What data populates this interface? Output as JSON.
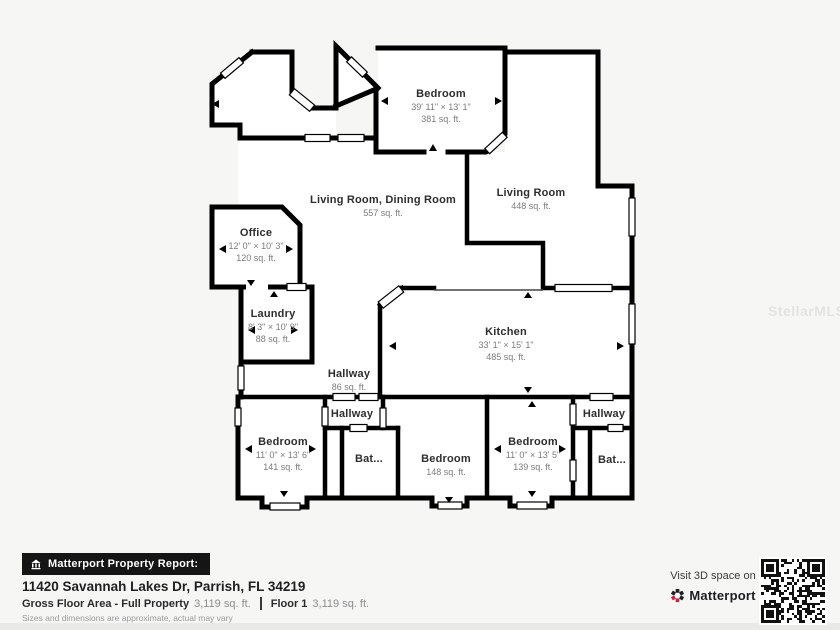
{
  "plan": {
    "rooms": [
      {
        "name": "Bedroom",
        "dims": "39' 11\" × 13' 1\"",
        "area": "381 sq. ft."
      },
      {
        "name": "Living Room, Dining Room",
        "area": "557 sq. ft."
      },
      {
        "name": "Living Room",
        "area": "448 sq. ft."
      },
      {
        "name": "Office",
        "dims": "12' 0\" × 10' 3\"",
        "area": "120 sq. ft."
      },
      {
        "name": "Laundry",
        "dims": "8' 3\" × 10' 9\"",
        "area": "88 sq. ft."
      },
      {
        "name": "Hallway",
        "area": "86 sq. ft."
      },
      {
        "name": "Kitchen",
        "dims": "33' 1\" × 15' 1\"",
        "area": "485 sq. ft."
      },
      {
        "name": "Hallway"
      },
      {
        "name": "Bedroom",
        "dims": "11' 0\" × 13' 6\"",
        "area": "141 sq. ft."
      },
      {
        "name": "Bat..."
      },
      {
        "name": "Bedroom",
        "area": "148 sq. ft."
      },
      {
        "name": "Bedroom",
        "dims": "11' 0\" × 13' 5\"",
        "area": "139 sq. ft."
      },
      {
        "name": "Hallway"
      },
      {
        "name": "Bat..."
      }
    ]
  },
  "watermark": "StellarMLS",
  "footer": {
    "report_label": "Matterport Property Report:",
    "address": "11420 Savannah Lakes Dr, Parrish, FL 34219",
    "gross_label": "Gross Floor Area - Full Property",
    "gross_value": "3,119 sq. ft.",
    "floor_label": "Floor 1",
    "floor_value": "3,119 sq. ft.",
    "disclaimer": "Sizes and dimensions are approximate, actual may vary"
  },
  "cta": {
    "visit_label": "Visit 3D space on",
    "brand": "Matterport"
  },
  "colors": {
    "wall": "#000000",
    "room_fill": "#ffffff",
    "page_bg": "#f6f6f5",
    "badge_bg": "#151515",
    "brand_red": "#c2294b"
  }
}
